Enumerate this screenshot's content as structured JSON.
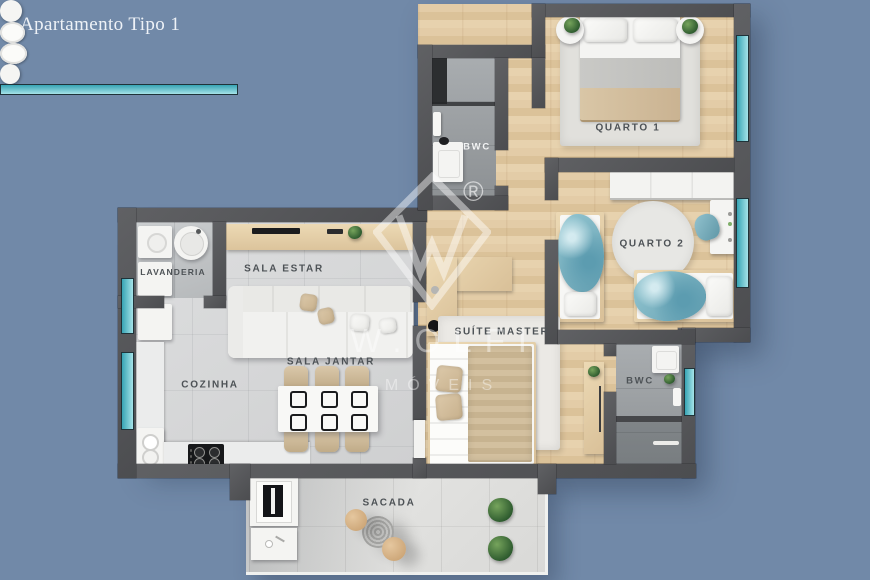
{
  "title": "Apartamento Tipo 1",
  "watermark": {
    "registered": "®",
    "brand": "W.OLFI",
    "tagline": "MÓVEIS"
  },
  "rooms": {
    "quarto1": "QUARTO 1",
    "quarto2": "QUARTO 2",
    "bwc_social": "BWC",
    "lavanderia": "LAVANDERIA",
    "sala_estar": "SALA ESTAR",
    "cozinha": "COZINHA",
    "sala_jantar": "SALA JANTAR",
    "suite_master": "SUÍTE MASTER",
    "bwc_suite": "BWC",
    "sacada": "SACADA"
  },
  "palette": {
    "background": "#7189a8",
    "wall": "#55565a",
    "wood_floor": "#dfc8a3",
    "tile_floor": "#d7d8d9",
    "bath_tile": "#9aa0a3",
    "window_glass": "#6fc9d6",
    "label_text": "#4d5256",
    "blanket_blue": "#7db6c6",
    "furniture_white": "#f4f4f2"
  }
}
